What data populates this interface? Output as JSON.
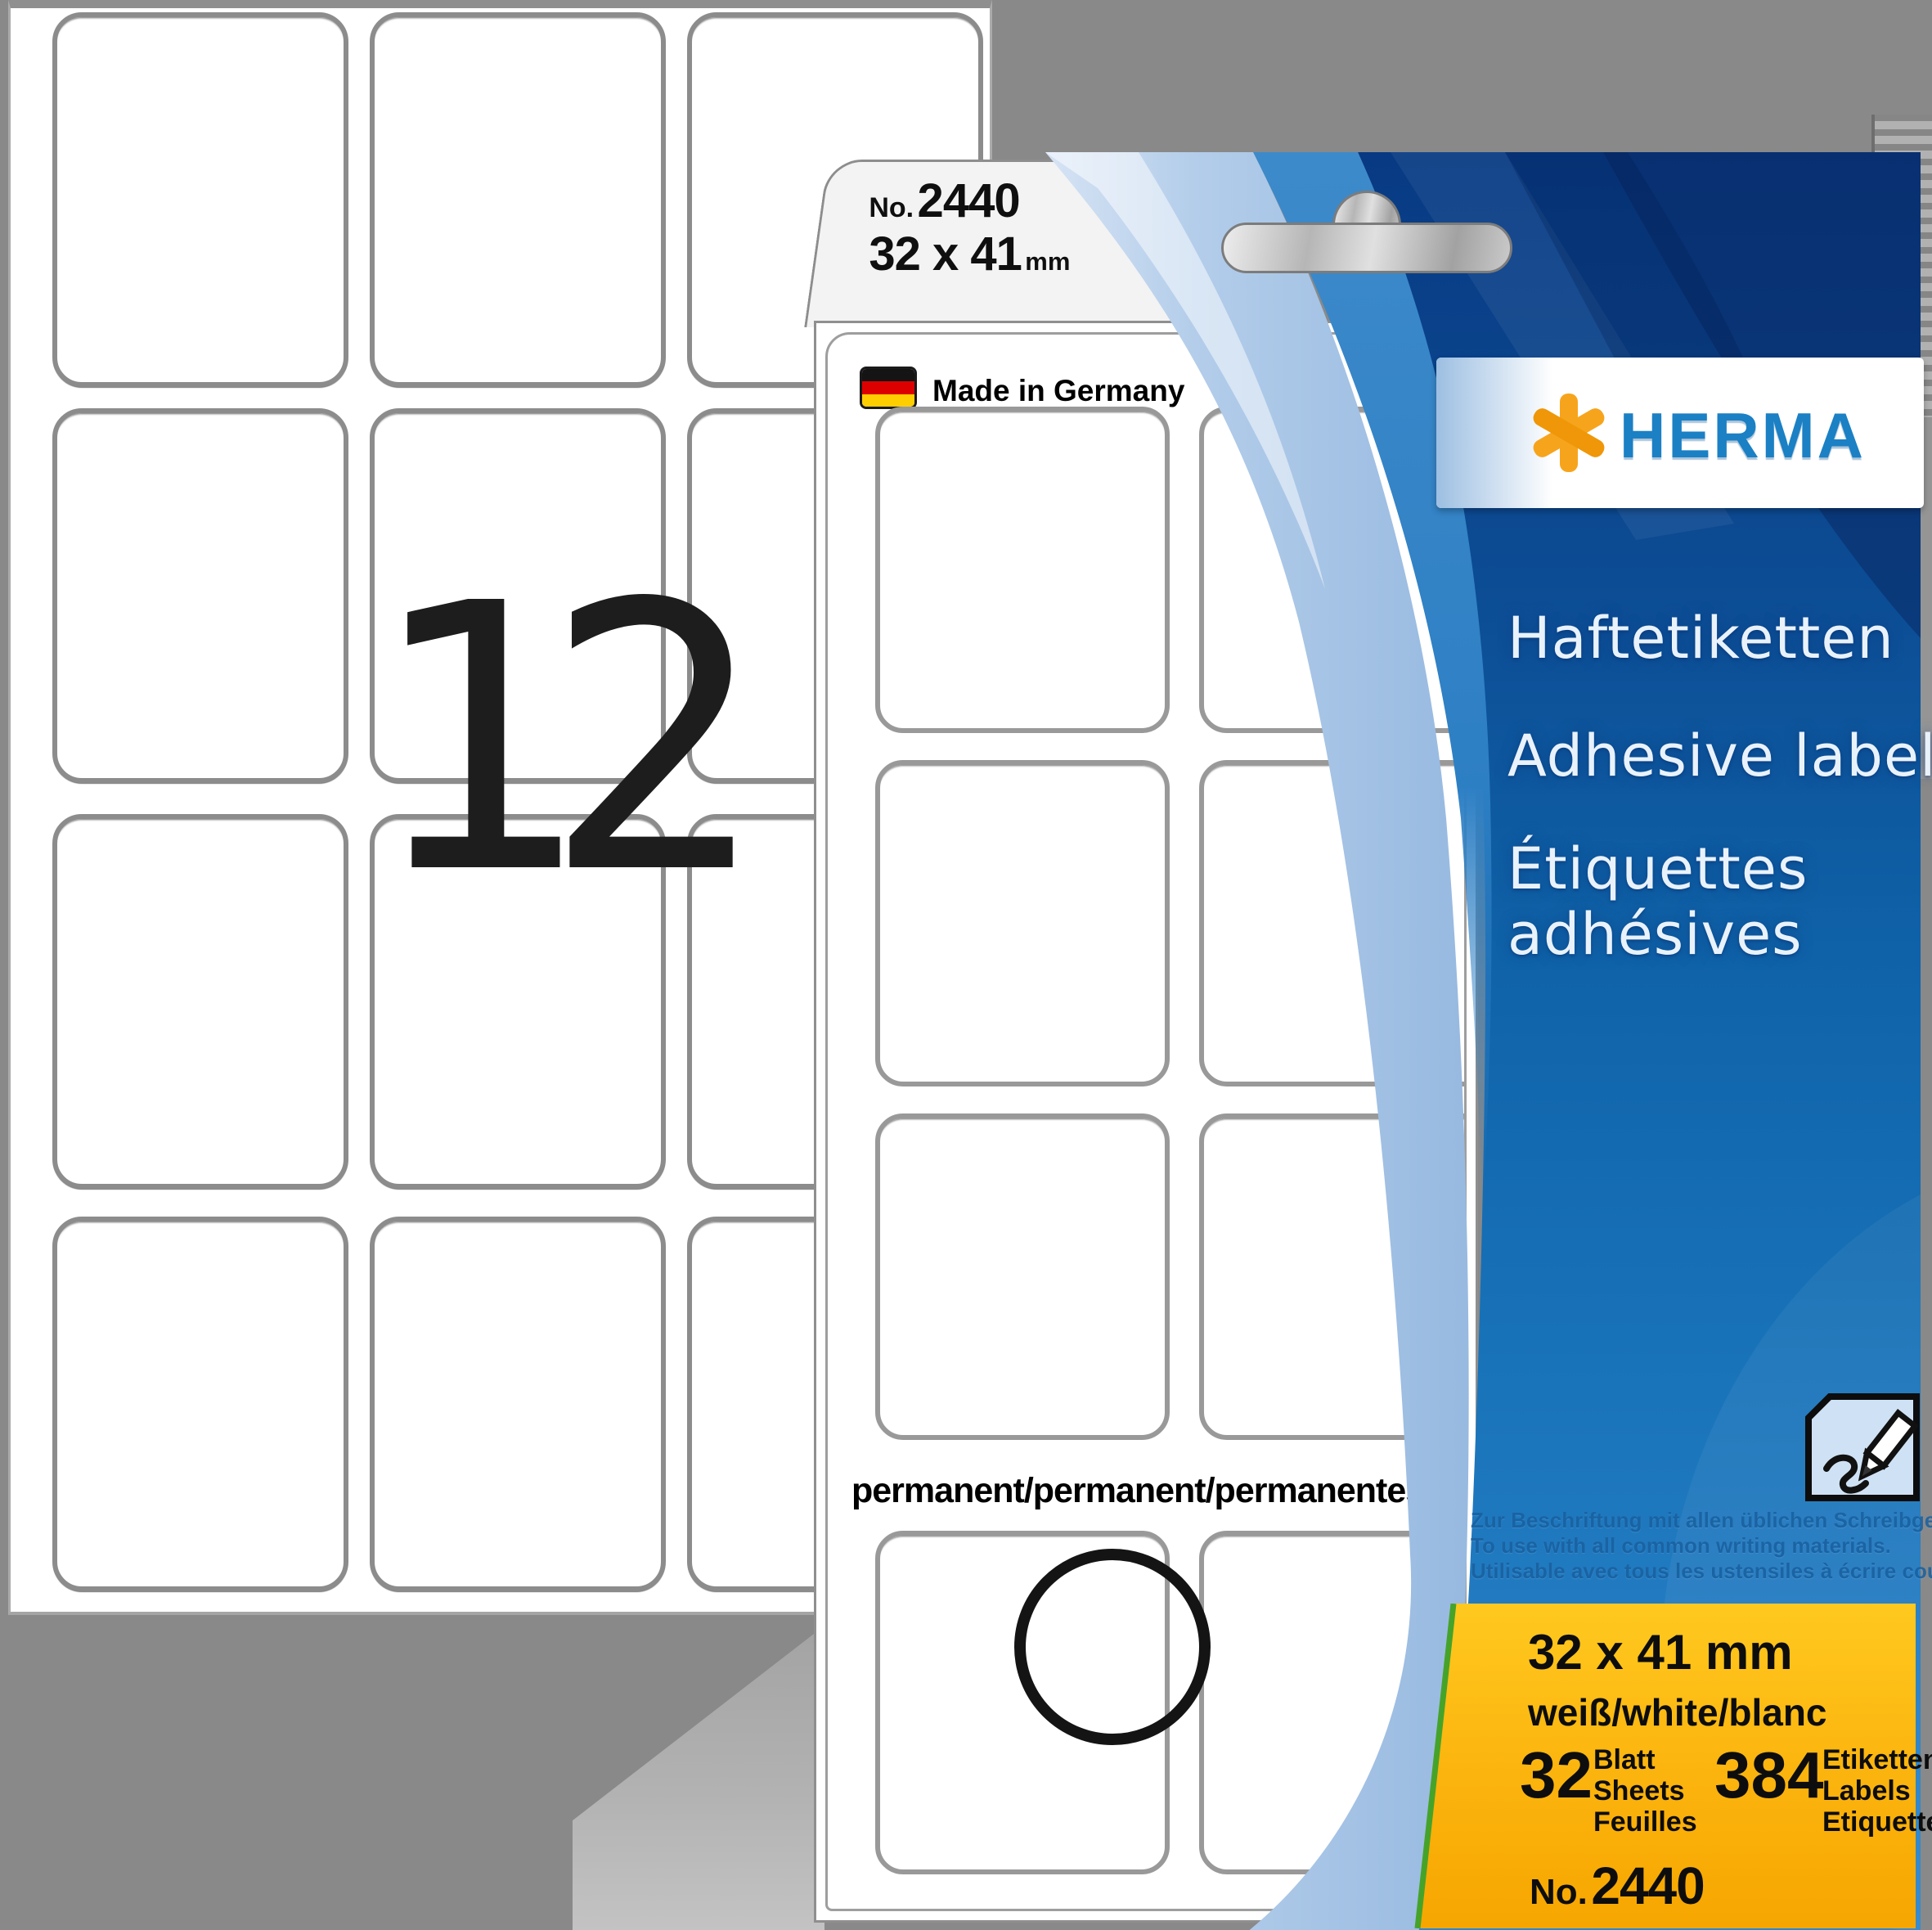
{
  "back_sheet": {
    "big_count": "12",
    "label_count": 12
  },
  "tab": {
    "no_label": "No.",
    "product_no": "2440",
    "size": "32 x 41",
    "size_unit": "mm"
  },
  "card": {
    "made_in": "Made in Germany",
    "permanent": "permanent/permanent/permanentes",
    "flag_icon": "german-flag"
  },
  "brand": {
    "name": "HERMA",
    "logo_icon": "asterisk",
    "blue": "#1b80c4",
    "orange": "#f7a41d"
  },
  "titles": {
    "de": "Haftetiketten",
    "en": "Adhesive labels",
    "fr_line1": "Étiquettes",
    "fr_line2": "adhésives"
  },
  "usage": {
    "de": "Zur Beschriftung mit allen üblichen Schreibgeräten.",
    "en": "To use with all common writing materials.",
    "fr": "Utilisable avec tous les ustensiles à écrire courants."
  },
  "specs": {
    "size": "32 x 41 mm",
    "color": "weiß/white/blanc",
    "sheets_value": "32",
    "sheets_units": [
      "Blatt",
      "Sheets",
      "Feuilles"
    ],
    "labels_value": "384",
    "labels_units": [
      "Etiketten",
      "Labels",
      "Etiquettes"
    ],
    "order_label": "No.",
    "order_no": "2440"
  },
  "colors": {
    "background_gray": "#898989",
    "package_navy": "#0a3a85",
    "package_blue": "#1b77bc",
    "pale_swoosh": "#a8c6e8",
    "panel_yellow": "#fdb913",
    "green_edge": "#46a32a",
    "flag_black": "#141414",
    "flag_red": "#dd0000",
    "flag_gold": "#ffce00"
  }
}
